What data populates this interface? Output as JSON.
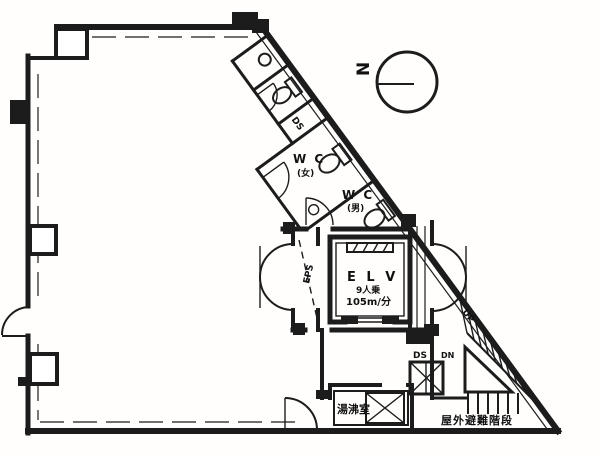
{
  "meta": {
    "type": "architectural-floor-plan",
    "width": 600,
    "height": 454
  },
  "labels": {
    "compass_n": "N",
    "wc_upper": "W C",
    "wc_upper_sub": "(女)",
    "wc_lower": "W C",
    "wc_lower_sub": "(男)",
    "ds_band": "DS",
    "eps": "EPS",
    "elv": "E L V",
    "elv_capacity": "9人乗",
    "elv_speed": "105m/分",
    "ds_shaft": "DS",
    "dn": "DN",
    "up": "UP",
    "kitchen": "湯沸室",
    "exit_stairs": "屋外避難階段"
  },
  "colors": {
    "ink": "#1c1c1c",
    "paper": "#ffffff"
  }
}
